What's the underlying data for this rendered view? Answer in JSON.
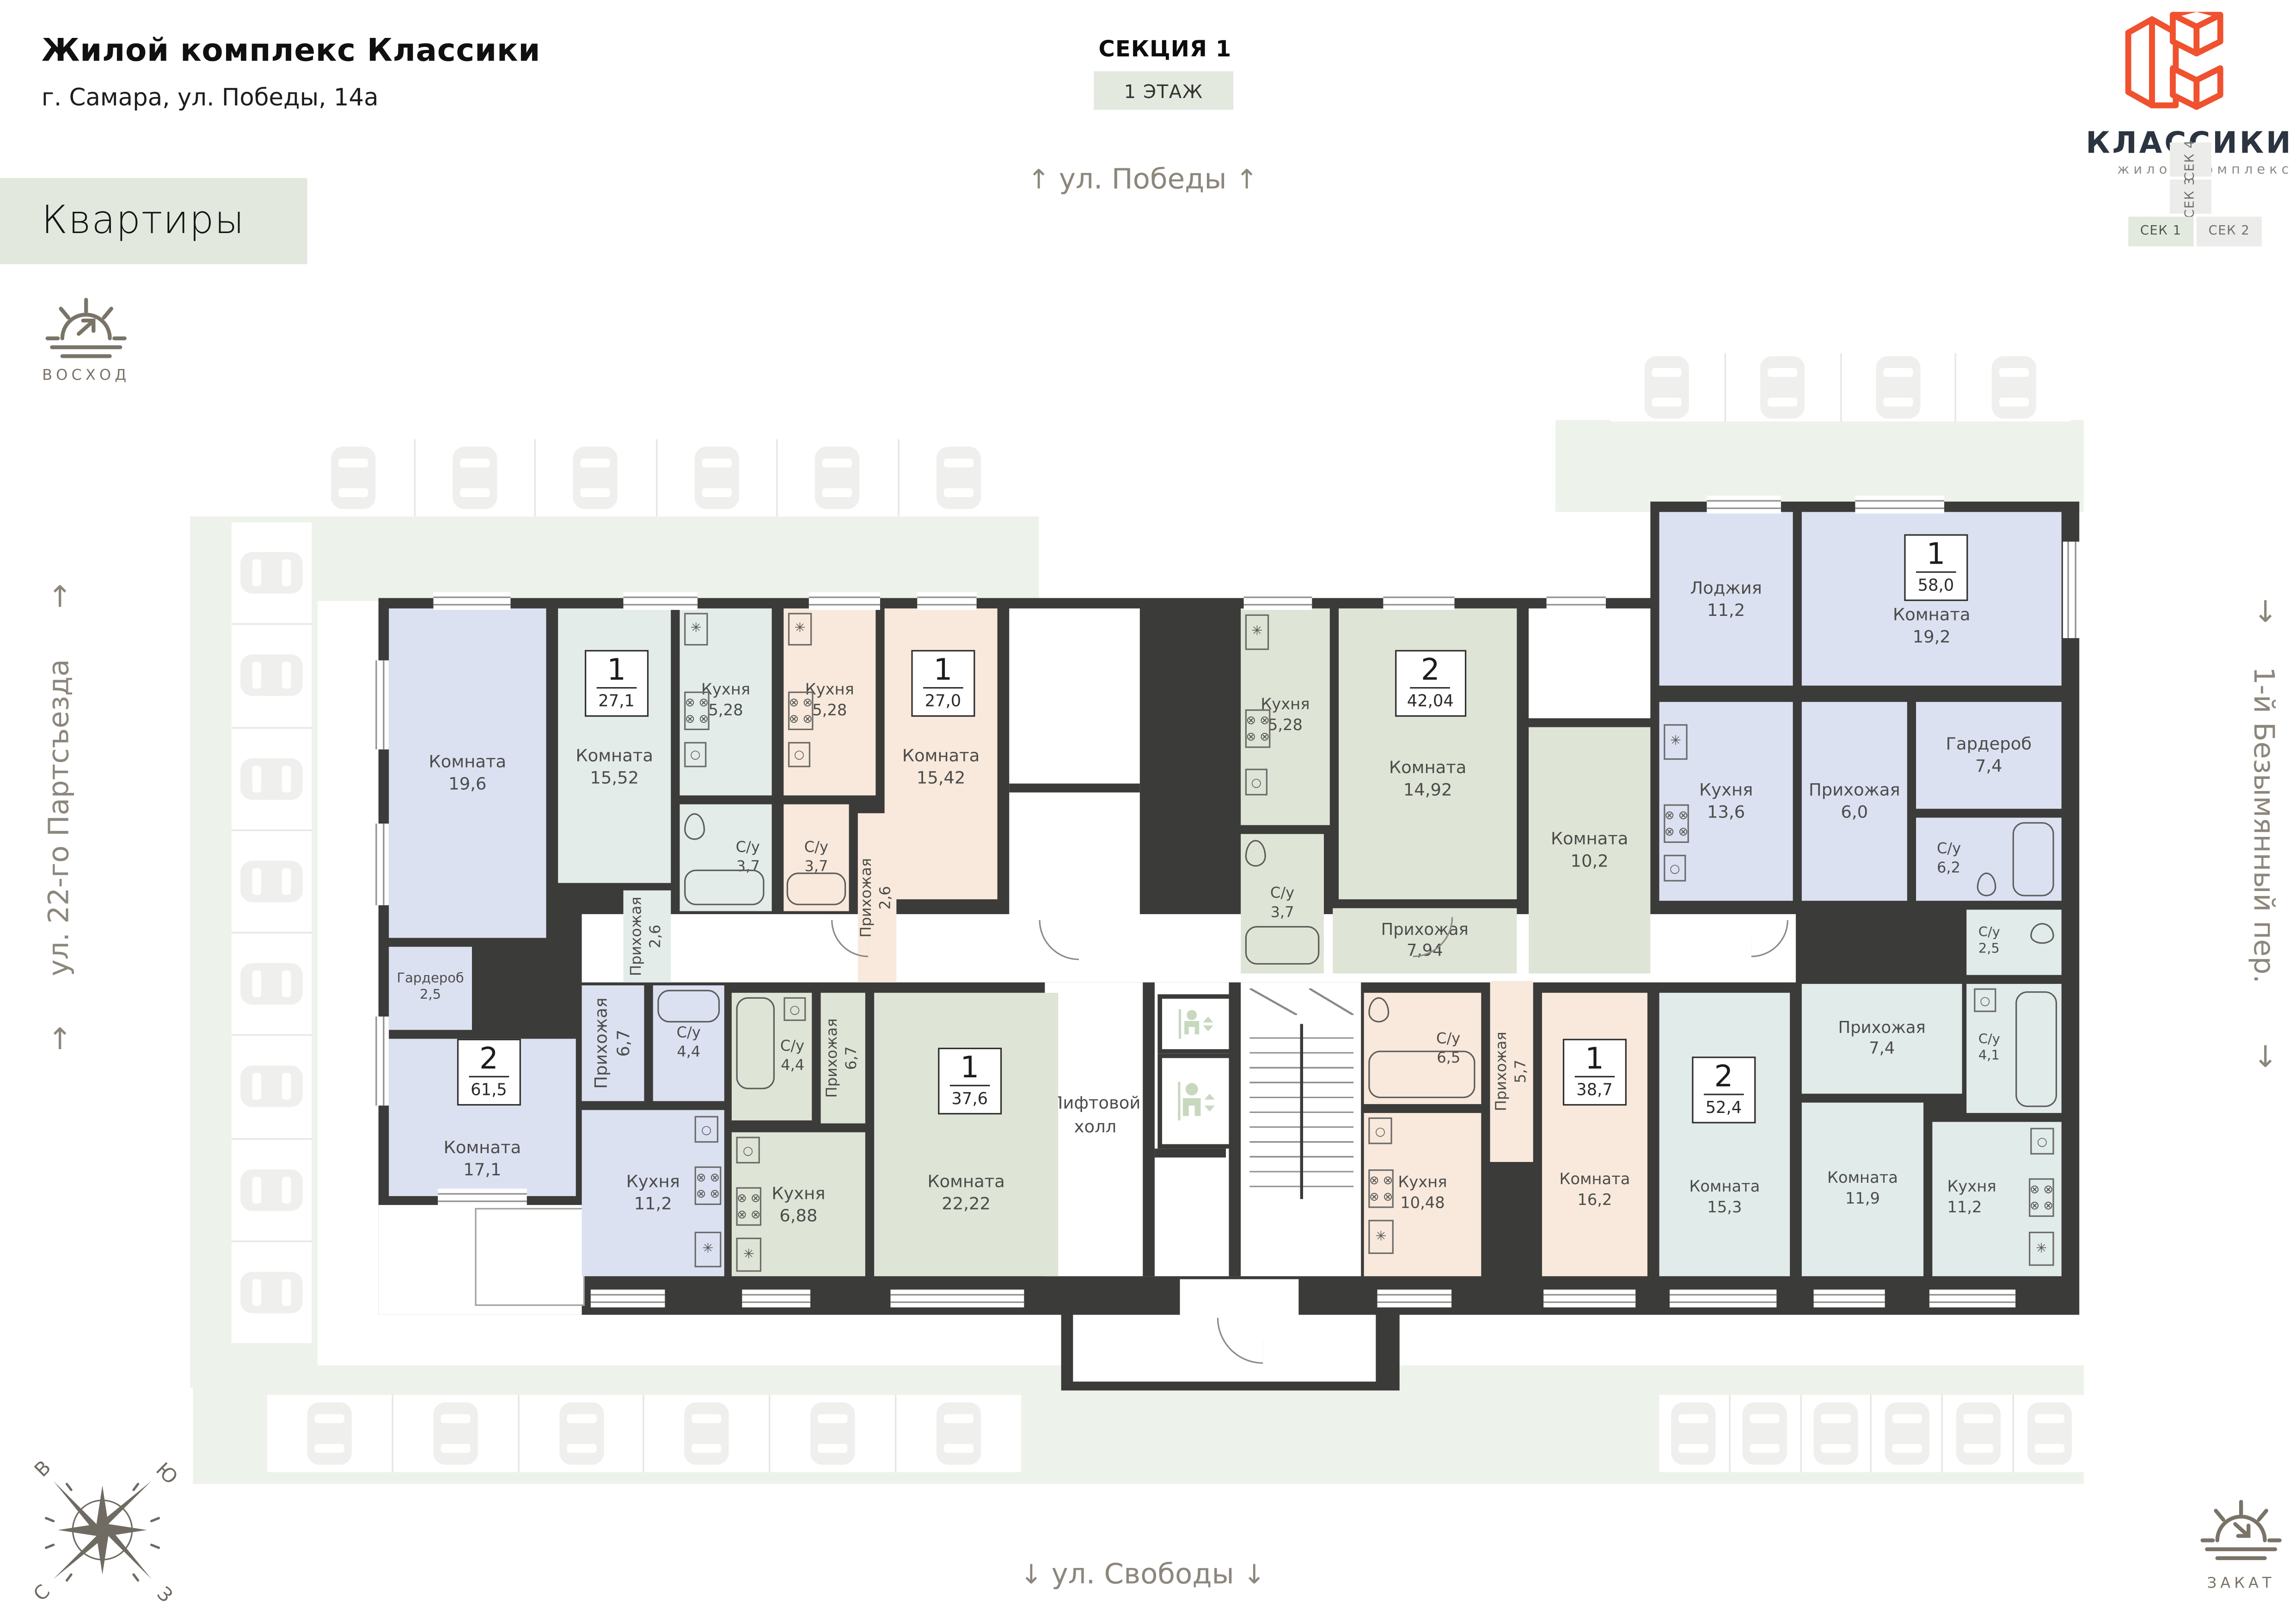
{
  "header": {
    "title": "Жилой комплекс Классики",
    "address": "г. Самара, ул. Победы, 14а"
  },
  "nav": {
    "apartments_label": "Квартиры"
  },
  "section_info": {
    "section": "СЕКЦИЯ 1",
    "floor": "1 ЭТАЖ"
  },
  "streets": {
    "top": "ул. Победы",
    "bottom": "ул. Свободы",
    "left": "ул. 22-го Партсъезда",
    "right": "1-й Безымянный пер.",
    "arrow_up": "↑",
    "arrow_down": "↓"
  },
  "sun": {
    "sunrise": "ВОСХОД",
    "sunset": "ЗАКАТ"
  },
  "logo": {
    "name": "КЛАССИКИ",
    "subtitle": "жилой комплекс",
    "accent_color": "#f0512f",
    "text_color": "#2b3440"
  },
  "section_selector": {
    "items": [
      {
        "label": "СЕК 1",
        "active": true
      },
      {
        "label": "СЕК 2",
        "active": false
      },
      {
        "label": "СЕК 3",
        "active": false
      },
      {
        "label": "СЕК 4",
        "active": false
      }
    ]
  },
  "compass": {
    "north": "С",
    "south": "Ю",
    "east": "В",
    "west": "З"
  },
  "plan": {
    "colors": {
      "walls": "#3b3b39",
      "lavender": "#dce1f2",
      "teal": "#e3ece9",
      "peach": "#f8e9dc",
      "sage": "#dfe5d6",
      "mint": "#e1ebe9",
      "lawn": "#edf3ea"
    },
    "common": {
      "lift_hall_line1": "Лифтовой",
      "lift_hall_line2": "холл"
    },
    "apartments": [
      {
        "id": "61_5",
        "type": "2",
        "total": "61,5",
        "rooms": [
          {
            "name": "Комната",
            "area": "19,6"
          },
          {
            "name": "Гардероб",
            "area": "2,5"
          },
          {
            "name": "Комната",
            "area": "17,1"
          },
          {
            "name": "Прихожая",
            "area": "6,7"
          },
          {
            "name": "С/у",
            "area": "4,4"
          },
          {
            "name": "Кухня",
            "area": "11,2"
          }
        ]
      },
      {
        "id": "27_1",
        "type": "1",
        "total": "27,1",
        "rooms": [
          {
            "name": "Комната",
            "area": "15,52"
          },
          {
            "name": "Кухня",
            "area": "5,28"
          },
          {
            "name": "С/у",
            "area": "3,7"
          },
          {
            "name": "Прихожая",
            "area": "2,6"
          }
        ]
      },
      {
        "id": "27_0",
        "type": "1",
        "total": "27,0",
        "rooms": [
          {
            "name": "Кухня",
            "area": "5,28"
          },
          {
            "name": "Комната",
            "area": "15,42"
          },
          {
            "name": "С/у",
            "area": "3,7"
          },
          {
            "name": "Прихожая",
            "area": "2,6"
          }
        ]
      },
      {
        "id": "42_04",
        "type": "2",
        "total": "42,04",
        "rooms": [
          {
            "name": "Кухня",
            "area": "5,28"
          },
          {
            "name": "Комната",
            "area": "14,92"
          },
          {
            "name": "С/у",
            "area": "3,7"
          },
          {
            "name": "Прихожая",
            "area": "7,94"
          },
          {
            "name": "Комната",
            "area": "10,2"
          }
        ]
      },
      {
        "id": "58_0",
        "type": "1",
        "total": "58,0",
        "rooms": [
          {
            "name": "Лоджия",
            "area": "11,2"
          },
          {
            "name": "Комната",
            "area": "19,2"
          },
          {
            "name": "Кухня",
            "area": "13,6"
          },
          {
            "name": "Прихожая",
            "area": "6,0"
          },
          {
            "name": "Гардероб",
            "area": "7,4"
          },
          {
            "name": "С/у",
            "area": "6,2"
          }
        ]
      },
      {
        "id": "37_6",
        "type": "1",
        "total": "37,6",
        "rooms": [
          {
            "name": "С/у",
            "area": "4,4"
          },
          {
            "name": "Прихожая",
            "area": "6,7"
          },
          {
            "name": "Кухня",
            "area": "6,88"
          },
          {
            "name": "Комната",
            "area": "22,22"
          }
        ]
      },
      {
        "id": "38_7",
        "type": "1",
        "total": "38,7",
        "rooms": [
          {
            "name": "С/у",
            "area": "6,5"
          },
          {
            "name": "Прихожая",
            "area": "5,7"
          },
          {
            "name": "Кухня",
            "area": "10,48"
          },
          {
            "name": "Комната",
            "area": "16,2"
          }
        ]
      },
      {
        "id": "52_4",
        "type": "2",
        "total": "52,4",
        "rooms": [
          {
            "name": "С/у",
            "area": "2,5"
          },
          {
            "name": "Прихожая",
            "area": "7,4"
          },
          {
            "name": "С/у",
            "area": "4,1"
          },
          {
            "name": "Комната",
            "area": "15,3"
          },
          {
            "name": "Комната",
            "area": "11,9"
          },
          {
            "name": "Кухня",
            "area": "11,2"
          }
        ]
      }
    ]
  },
  "parking": {
    "rows": [
      {
        "id": "top-middle",
        "cars": 6
      },
      {
        "id": "top-right",
        "cars": 4
      },
      {
        "id": "left",
        "cars": 8
      },
      {
        "id": "bottom-left",
        "cars": 6
      },
      {
        "id": "bottom-right",
        "cars": 6
      }
    ]
  }
}
